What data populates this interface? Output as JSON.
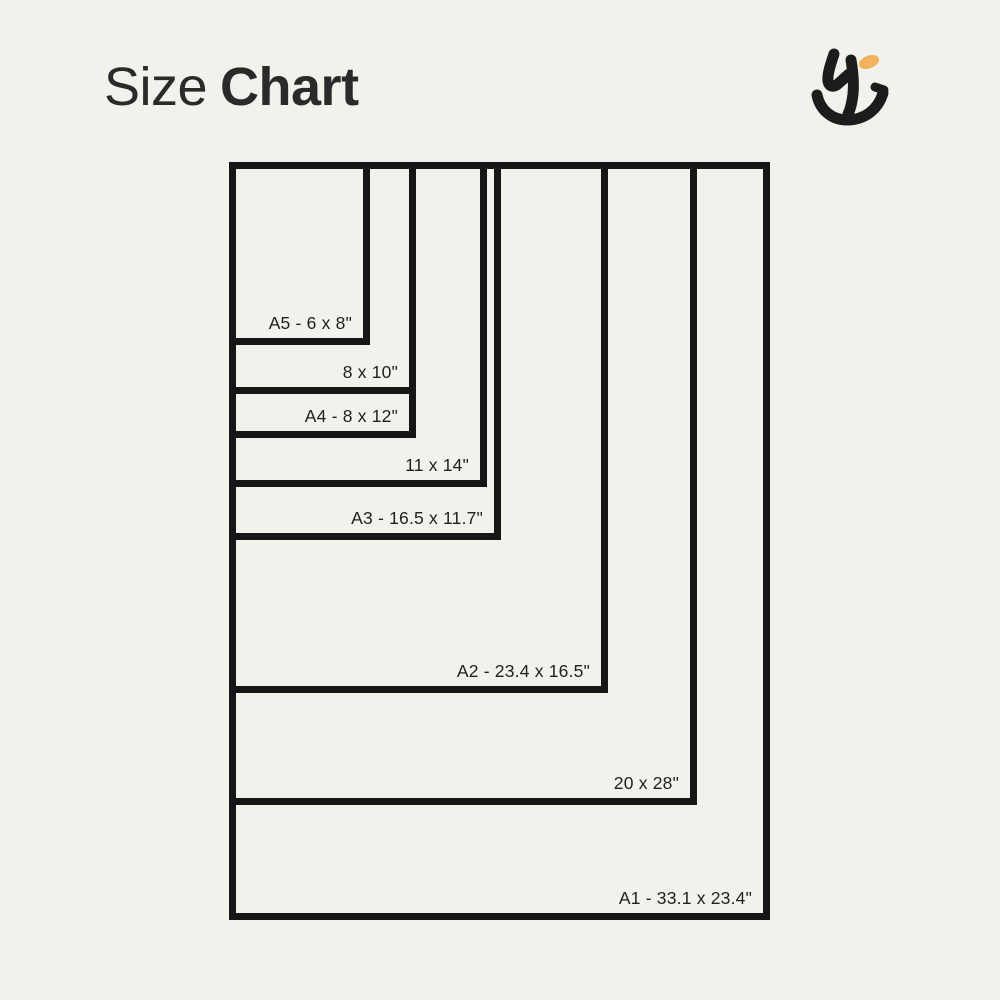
{
  "page": {
    "background_color": "#F2F1EC",
    "line_color": "#161616",
    "text_color": "#1F1F1F"
  },
  "header": {
    "title_regular": "Size",
    "title_bold": "Chart"
  },
  "logo": {
    "name": "hj-monogram",
    "ink_color": "#1C1C1C",
    "accent_color": "#F2B25C"
  },
  "chart_data": {
    "type": "table",
    "title": "Size Chart",
    "description": "Nested rectangles comparing print sizes, all aligned to a shared top-left corner",
    "origin": {
      "x": 229,
      "y": 162
    },
    "border_px": 7,
    "sizes": [
      {
        "id": "a5",
        "label": "A5 - 6 x 8\"",
        "box": {
          "w": 141,
          "h": 183
        }
      },
      {
        "id": "8x10",
        "label": "8 x 10\"",
        "box": {
          "w": 187,
          "h": 232
        }
      },
      {
        "id": "a4",
        "label": "A4 - 8 x 12\"",
        "box": {
          "w": 187,
          "h": 276
        }
      },
      {
        "id": "11x14",
        "label": "11 x 14\"",
        "box": {
          "w": 258,
          "h": 325
        }
      },
      {
        "id": "a3",
        "label": "A3 - 16.5 x 11.7\"",
        "box": {
          "w": 272,
          "h": 378
        }
      },
      {
        "id": "a2",
        "label": "A2 - 23.4 x 16.5\"",
        "box": {
          "w": 379,
          "h": 531
        }
      },
      {
        "id": "20x28",
        "label": "20 x 28\"",
        "box": {
          "w": 468,
          "h": 643
        }
      },
      {
        "id": "a1",
        "label": "A1 - 33.1 x 23.4\"",
        "box": {
          "w": 541,
          "h": 758
        }
      }
    ]
  }
}
